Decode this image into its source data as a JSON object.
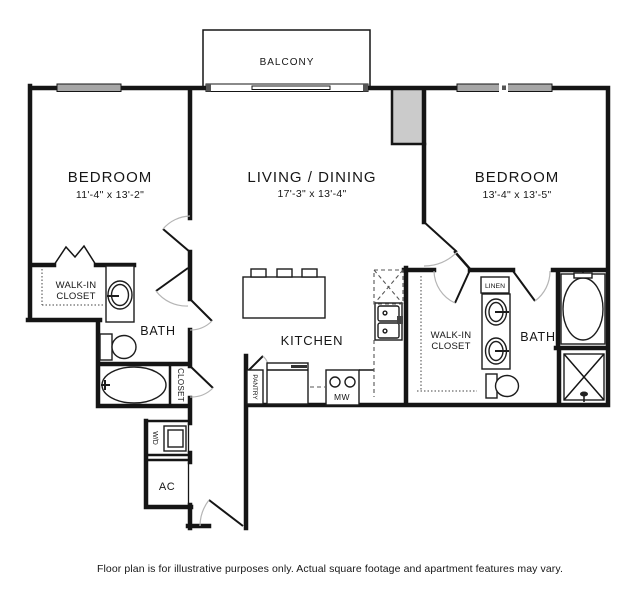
{
  "rooms": {
    "balcony": {
      "label": "BALCONY"
    },
    "bedroom_left": {
      "label": "BEDROOM",
      "dims": "11'-4\" x 13'-2\""
    },
    "living_dining": {
      "label": "LIVING / DINING",
      "dims": "17'-3\" x 13'-4\""
    },
    "bedroom_right": {
      "label": "BEDROOM",
      "dims": "13'-4\" x 13'-5\""
    },
    "kitchen": {
      "label": "KITCHEN"
    },
    "bath_left": {
      "label": "BATH"
    },
    "bath_right": {
      "label": "BATH"
    },
    "walk_in_closet_left": {
      "line1": "WALK-IN",
      "line2": "CLOSET"
    },
    "walk_in_closet_right": {
      "line1": "WALK-IN",
      "line2": "CLOSET"
    },
    "closet": {
      "label": "CLOSET"
    },
    "pantry": {
      "label": "PANTRY"
    },
    "linen": {
      "label": "LINEN"
    },
    "laundry": {
      "label": "W/D"
    },
    "ac_closet": {
      "label": "AC"
    },
    "microwave": {
      "label": "MW"
    }
  },
  "footer": {
    "disclaimer": "Floor plan is for illustrative purposes only.  Actual square footage and apartment features may vary."
  },
  "colors": {
    "wall": "#151515",
    "window_fill": "#a6a6a6",
    "chase_fill": "#cbcbcb",
    "door_arc": "#b5b5b5",
    "background": "#ffffff"
  }
}
